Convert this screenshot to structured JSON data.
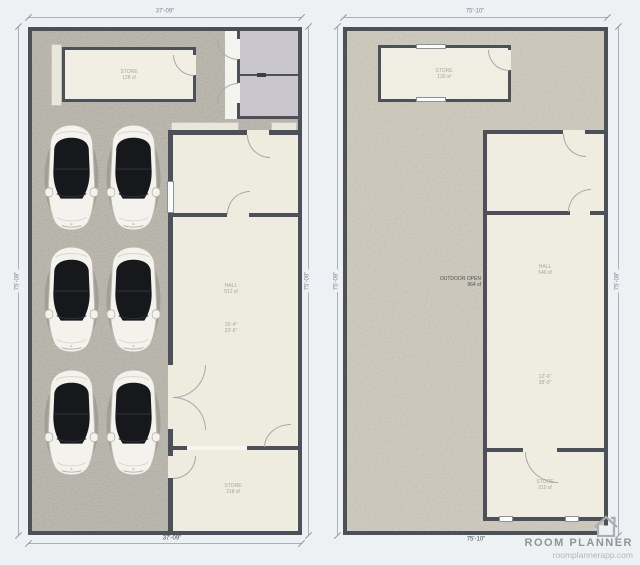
{
  "watermark": {
    "title": "ROOM PLANNER",
    "url": "roomplannerapp.com"
  },
  "left_plan": {
    "dims": {
      "top": "37'-09\"",
      "bottom": "37'-09\"",
      "left": "75'-08\"",
      "right": "75'-08\""
    },
    "labels": {
      "store_top": {
        "l1": "STORE",
        "l2": "128 sf"
      },
      "hall_a": {
        "l1": "HALL",
        "l2": "512 sf"
      },
      "hall_b": {
        "l1": "15'-4\"",
        "l2": "33'-6\""
      },
      "store_bottom": {
        "l1": "STORE",
        "l2": "218 sf"
      }
    }
  },
  "right_plan": {
    "dims": {
      "top": "75'-10\"",
      "bottom": "75'-10\"",
      "left": "75'-08\"",
      "right": "75'-08\""
    },
    "labels": {
      "store_top": {
        "l1": "STORE",
        "l2": "130 sf"
      },
      "outdoor": {
        "l1": "OUTDOOR OPEN",
        "l2": "964 sf"
      },
      "hall_a": {
        "l1": "HALL",
        "l2": "540 sf"
      },
      "hall_b": {
        "l1": "12'-6\"",
        "l2": "38'-0\""
      },
      "store_bottom": {
        "l1": "STORE",
        "l2": "210 sf"
      }
    }
  }
}
